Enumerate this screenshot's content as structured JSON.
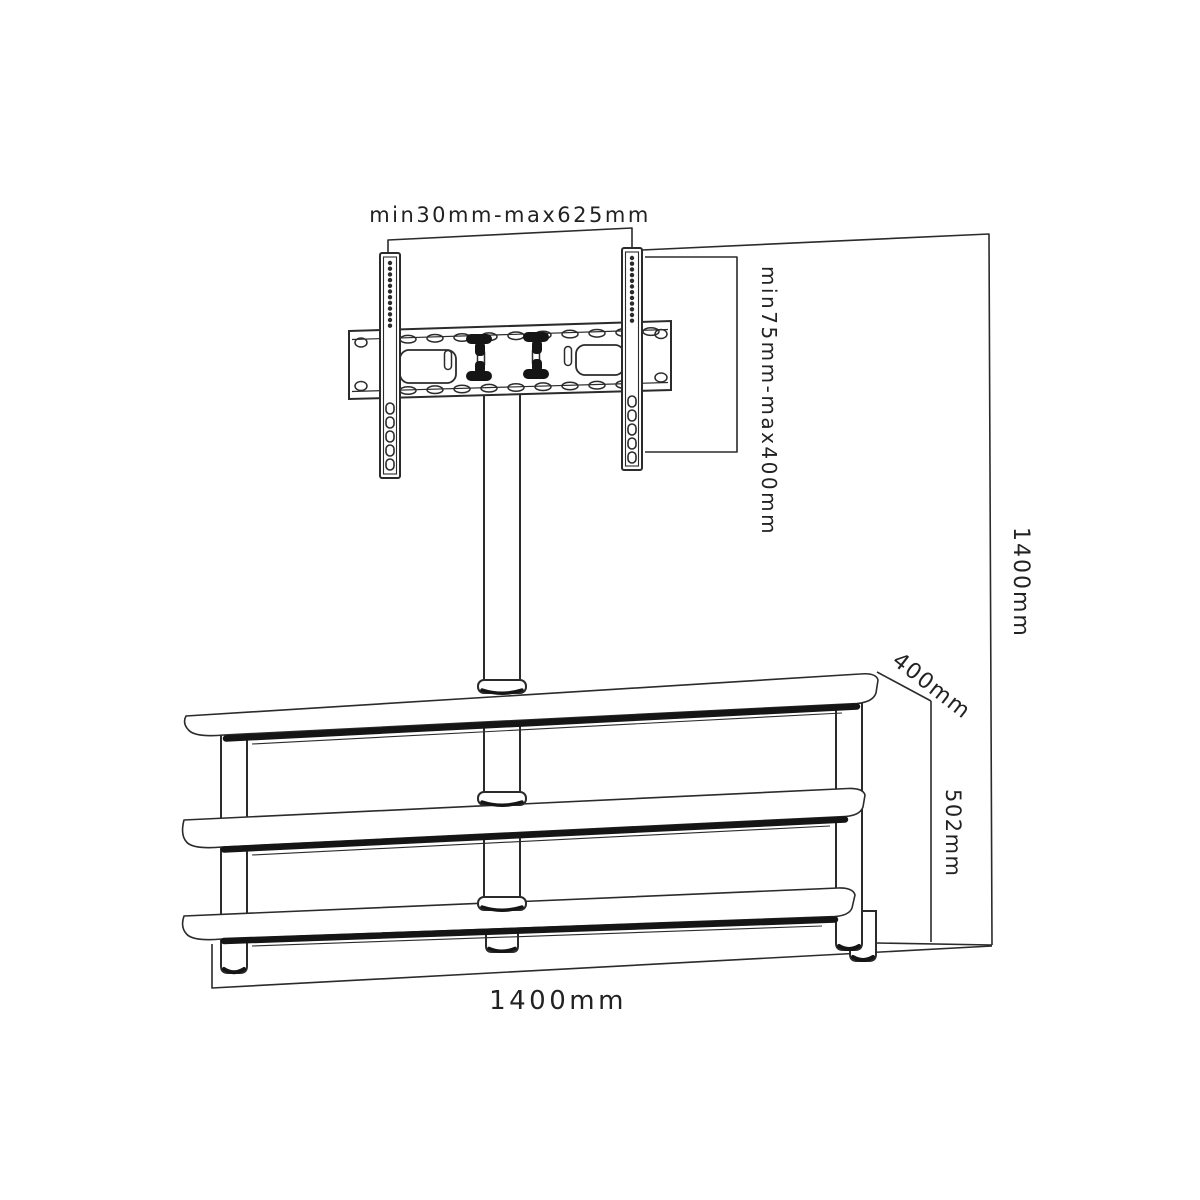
{
  "diagram": {
    "labels": {
      "bracket_rail_span": "min30mm-max625mm",
      "bracket_vesa_height": "min75mm-max400mm",
      "overall_height": "1400mm",
      "shelf_depth": "400mm",
      "stand_height": "502mm",
      "stand_width": "1400mm"
    },
    "colors": {
      "line": "#2b2b2b",
      "edge": "#151515",
      "text": "#222222",
      "background": "#ffffff"
    }
  }
}
